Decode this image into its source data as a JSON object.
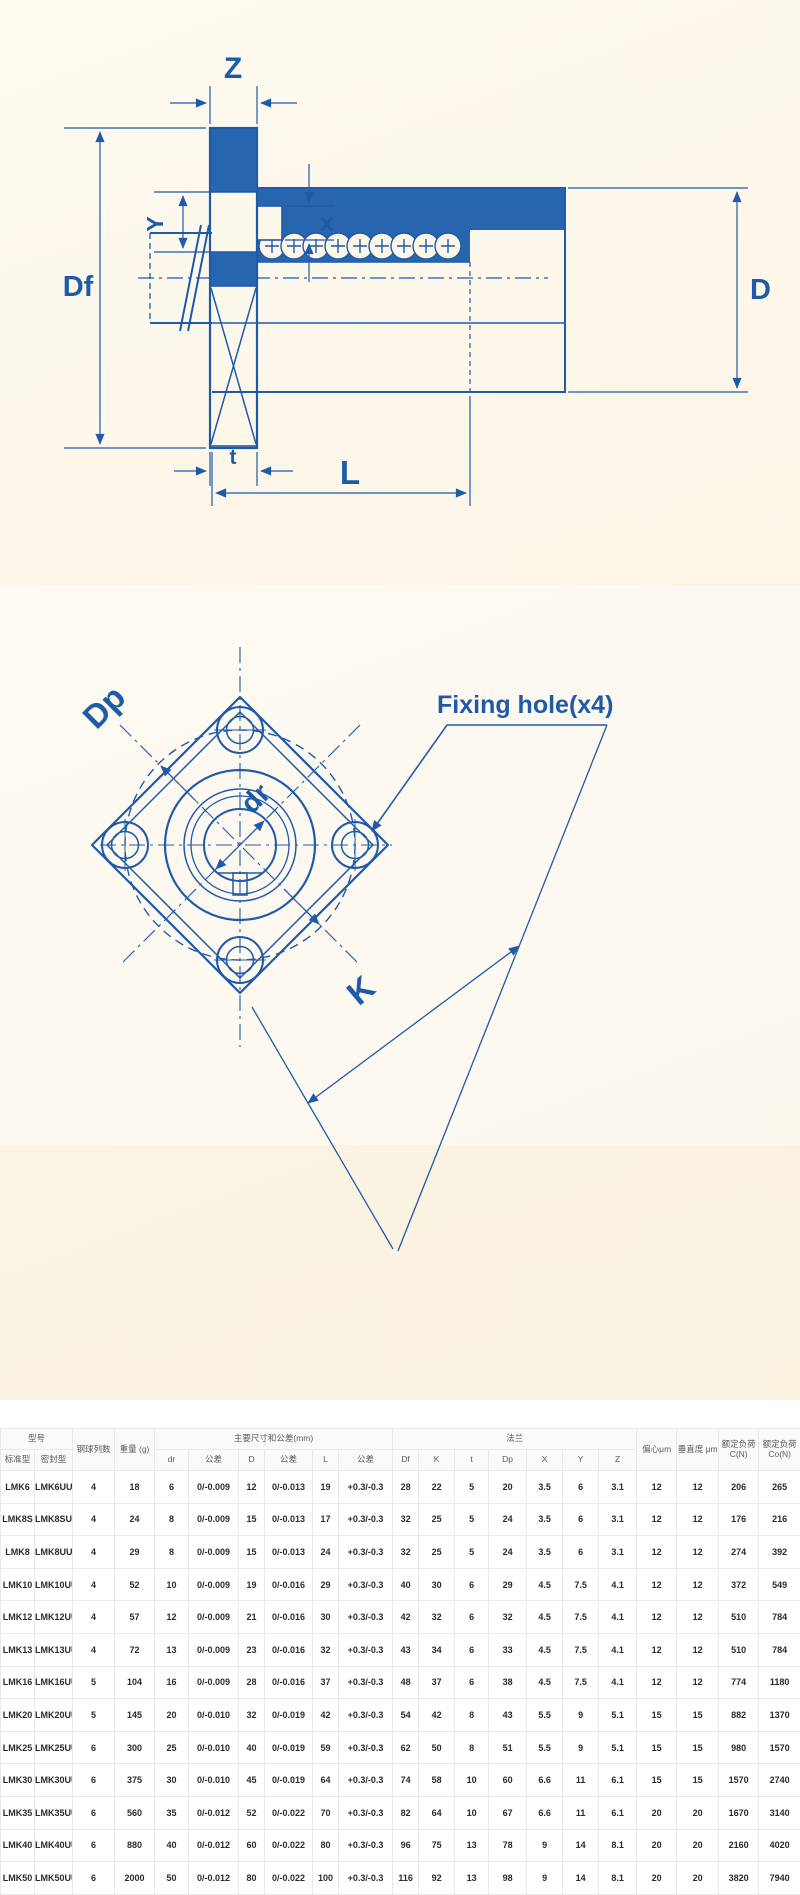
{
  "colors": {
    "drawing_line_blue": "#1e5aa8",
    "drawing_fill_blue": "#2766ae",
    "background_cream": "#fbf4e4",
    "table_border_gray": "#e9e9e9"
  },
  "side_view_diagram": {
    "labels": {
      "Z": "Z",
      "Y": "Y",
      "x": "x",
      "Df": "Df",
      "D": "D",
      "t": "t",
      "L": "L"
    }
  },
  "front_view_diagram": {
    "labels": {
      "Dp": "Dp",
      "dr": "dr",
      "K": "K",
      "fixing_hole": "Fixing hole(x4)"
    }
  },
  "table": {
    "header": {
      "model": "型号",
      "standard": "标准型",
      "sealed": "密封型",
      "ball_rows": "钢球列数",
      "weight": "重量 (g)",
      "main_dims": "主要尺寸和公差(mm)",
      "dr": "dr",
      "tolerance": "公差",
      "D": "D",
      "L": "L",
      "flange": "法兰",
      "Df": "Df",
      "K": "K",
      "t": "t",
      "Dp": "Dp",
      "X": "X",
      "Y": "Y",
      "Z": "Z",
      "eccentricity": "偏心μm",
      "perpendicularity": "垂直度 μm",
      "rated_dynamic_load": "额定负荷 C(N)",
      "rated_static_load": "额定负荷 Co(N)"
    },
    "rows": [
      [
        "LMK6",
        "LMK6UU",
        "4",
        "18",
        "6",
        "0/-0.009",
        "12",
        "0/-0.013",
        "19",
        "+0.3/-0.3",
        "28",
        "22",
        "5",
        "20",
        "3.5",
        "6",
        "3.1",
        "12",
        "12",
        "206",
        "265"
      ],
      [
        "LMK8S",
        "LMK8SUU",
        "4",
        "24",
        "8",
        "0/-0.009",
        "15",
        "0/-0.013",
        "17",
        "+0.3/-0.3",
        "32",
        "25",
        "5",
        "24",
        "3.5",
        "6",
        "3.1",
        "12",
        "12",
        "176",
        "216"
      ],
      [
        "LMK8",
        "LMK8UU",
        "4",
        "29",
        "8",
        "0/-0.009",
        "15",
        "0/-0.013",
        "24",
        "+0.3/-0.3",
        "32",
        "25",
        "5",
        "24",
        "3.5",
        "6",
        "3.1",
        "12",
        "12",
        "274",
        "392"
      ],
      [
        "LMK10",
        "LMK10UU",
        "4",
        "52",
        "10",
        "0/-0.009",
        "19",
        "0/-0.016",
        "29",
        "+0.3/-0.3",
        "40",
        "30",
        "6",
        "29",
        "4.5",
        "7.5",
        "4.1",
        "12",
        "12",
        "372",
        "549"
      ],
      [
        "LMK12",
        "LMK12UU",
        "4",
        "57",
        "12",
        "0/-0.009",
        "21",
        "0/-0.016",
        "30",
        "+0.3/-0.3",
        "42",
        "32",
        "6",
        "32",
        "4.5",
        "7.5",
        "4.1",
        "12",
        "12",
        "510",
        "784"
      ],
      [
        "LMK13",
        "LMK13UU",
        "4",
        "72",
        "13",
        "0/-0.009",
        "23",
        "0/-0.016",
        "32",
        "+0.3/-0.3",
        "43",
        "34",
        "6",
        "33",
        "4.5",
        "7.5",
        "4.1",
        "12",
        "12",
        "510",
        "784"
      ],
      [
        "LMK16",
        "LMK16UU",
        "5",
        "104",
        "16",
        "0/-0.009",
        "28",
        "0/-0.016",
        "37",
        "+0.3/-0.3",
        "48",
        "37",
        "6",
        "38",
        "4.5",
        "7.5",
        "4.1",
        "12",
        "12",
        "774",
        "1180"
      ],
      [
        "LMK20",
        "LMK20UU",
        "5",
        "145",
        "20",
        "0/-0.010",
        "32",
        "0/-0.019",
        "42",
        "+0.3/-0.3",
        "54",
        "42",
        "8",
        "43",
        "5.5",
        "9",
        "5.1",
        "15",
        "15",
        "882",
        "1370"
      ],
      [
        "LMK25",
        "LMK25UU",
        "6",
        "300",
        "25",
        "0/-0.010",
        "40",
        "0/-0.019",
        "59",
        "+0.3/-0.3",
        "62",
        "50",
        "8",
        "51",
        "5.5",
        "9",
        "5.1",
        "15",
        "15",
        "980",
        "1570"
      ],
      [
        "LMK30",
        "LMK30UU",
        "6",
        "375",
        "30",
        "0/-0.010",
        "45",
        "0/-0.019",
        "64",
        "+0.3/-0.3",
        "74",
        "58",
        "10",
        "60",
        "6.6",
        "11",
        "6.1",
        "15",
        "15",
        "1570",
        "2740"
      ],
      [
        "LMK35",
        "LMK35UU",
        "6",
        "560",
        "35",
        "0/-0.012",
        "52",
        "0/-0.022",
        "70",
        "+0.3/-0.3",
        "82",
        "64",
        "10",
        "67",
        "6.6",
        "11",
        "6.1",
        "20",
        "20",
        "1670",
        "3140"
      ],
      [
        "LMK40",
        "LMK40UU",
        "6",
        "880",
        "40",
        "0/-0.012",
        "60",
        "0/-0.022",
        "80",
        "+0.3/-0.3",
        "96",
        "75",
        "13",
        "78",
        "9",
        "14",
        "8.1",
        "20",
        "20",
        "2160",
        "4020"
      ],
      [
        "LMK50",
        "LMK50UU",
        "6",
        "2000",
        "50",
        "0/-0.012",
        "80",
        "0/-0.022",
        "100",
        "+0.3/-0.3",
        "116",
        "92",
        "13",
        "98",
        "9",
        "14",
        "8.1",
        "20",
        "20",
        "3820",
        "7940"
      ],
      [
        "LME60",
        "LMK60UU",
        "6",
        "2560",
        "60",
        "0/-0.015",
        "90",
        "0/-0.025",
        "110",
        "+0.3/-0.3",
        "134",
        "106",
        "18",
        "112",
        "11",
        "17",
        "11.1",
        "25",
        "25",
        "4700",
        "10000"
      ]
    ]
  }
}
